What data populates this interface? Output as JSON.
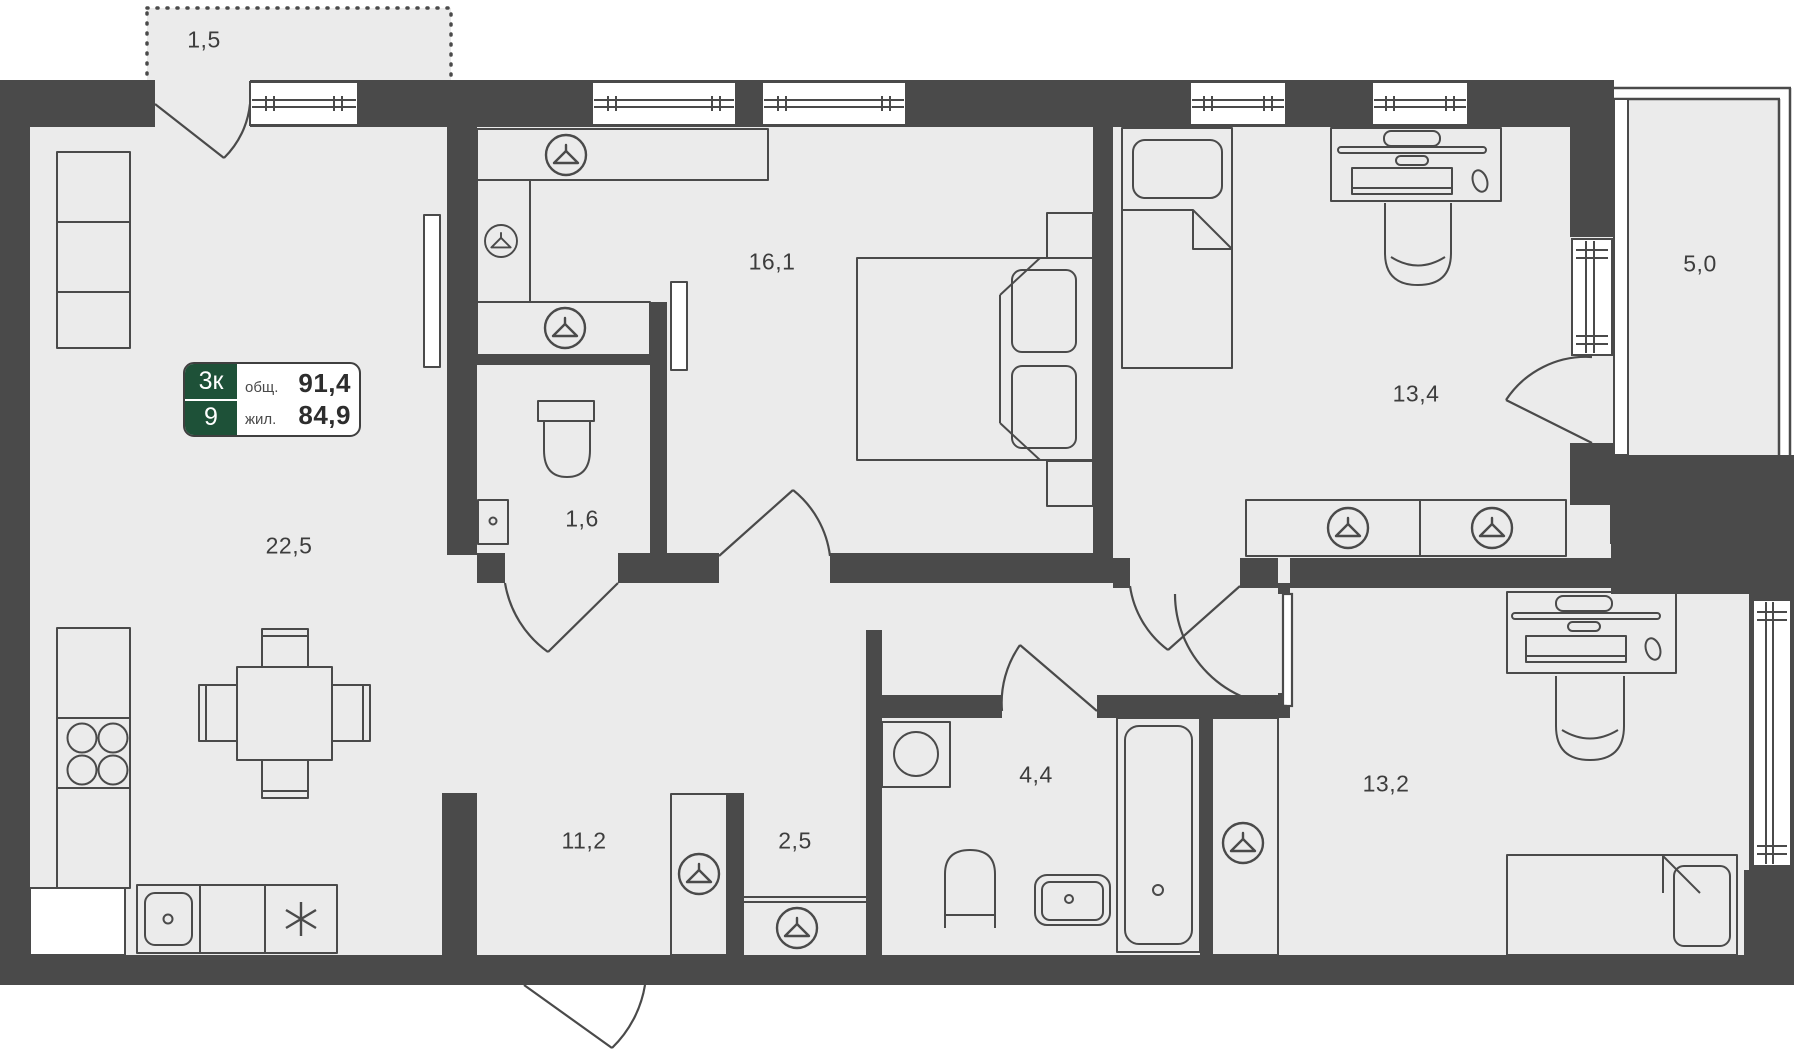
{
  "type": "apartment-floor-plan",
  "badge": {
    "rooms_label": "3к",
    "floor_label": "9",
    "total_label": "общ.",
    "total_value": "91,4",
    "living_label": "жил.",
    "living_value": "84,9"
  },
  "rooms": [
    {
      "id": "balcony-top-left",
      "area_label": "1,5"
    },
    {
      "id": "kitchen-living-room",
      "area_label": "22,5"
    },
    {
      "id": "bedroom",
      "area_label": "16,1"
    },
    {
      "id": "wc",
      "area_label": "1,6"
    },
    {
      "id": "hallway",
      "area_label": "11,2"
    },
    {
      "id": "corridor",
      "area_label": "2,5"
    },
    {
      "id": "bathroom",
      "area_label": "4,4"
    },
    {
      "id": "room-13-4",
      "area_label": "13,4"
    },
    {
      "id": "room-13-2",
      "area_label": "13,2"
    },
    {
      "id": "balcony-right",
      "area_label": "5,0"
    }
  ],
  "icons": {
    "wardrobe_marker": "hanger-icon",
    "fridge_marker": "snowflake-icon"
  },
  "colors": {
    "wall": "#4a4a4a",
    "floor": "#ebebeb",
    "outline": "#4a4a4a",
    "badge_green": "#1e5138",
    "badge_border": "#3f3f3f",
    "label_text": "#3d3d3d",
    "background": "#ffffff"
  }
}
